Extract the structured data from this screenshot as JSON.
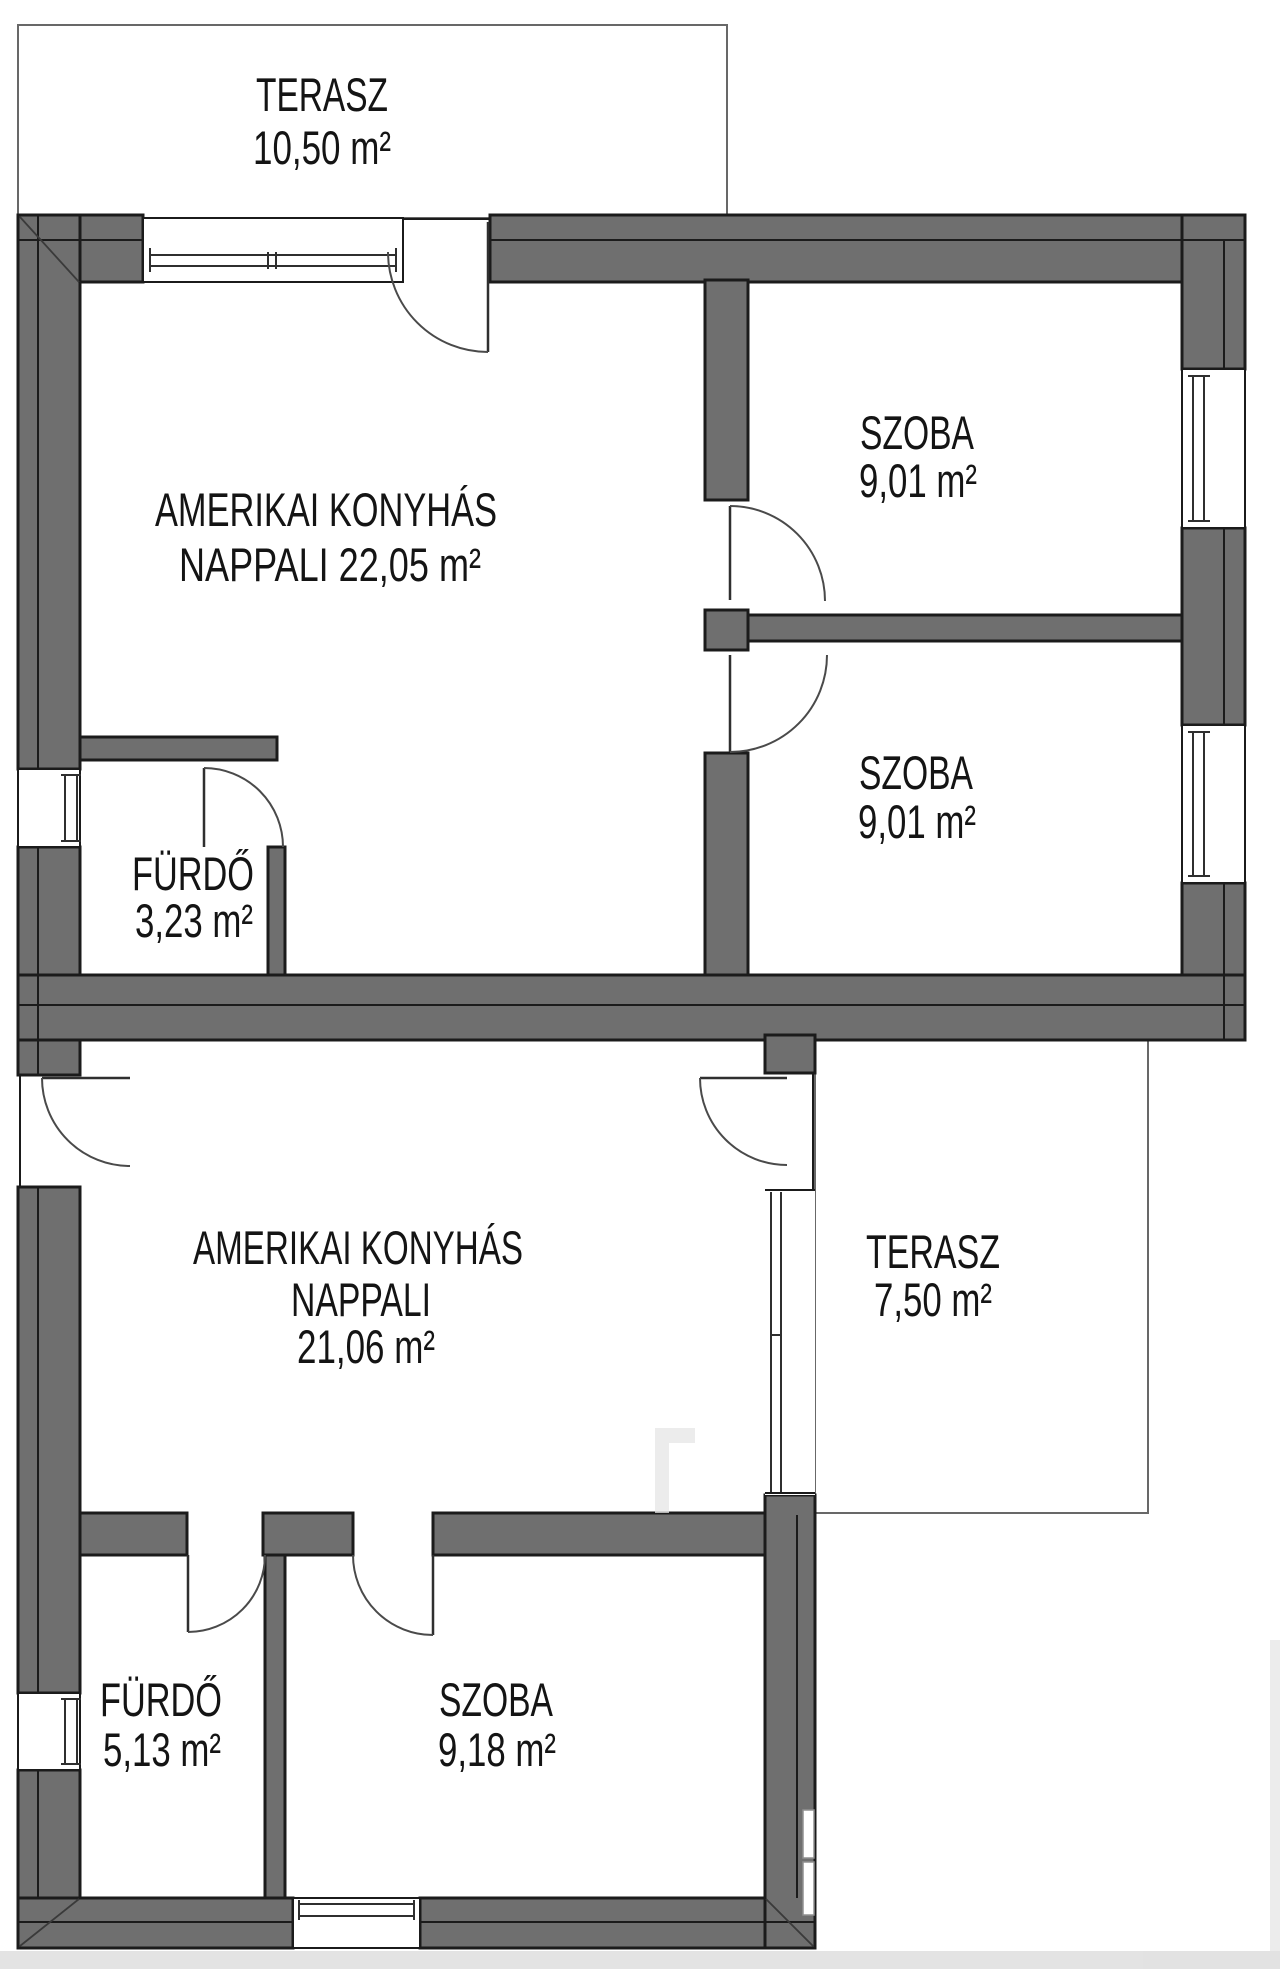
{
  "plan": {
    "type": "floor-plan",
    "language": "hu"
  },
  "rooms": [
    {
      "id": "terasz-felso",
      "lines": [
        "TERASZ",
        "10,50 m²"
      ]
    },
    {
      "id": "nappali-felso",
      "lines": [
        "AMERIKAI KONYHÁS",
        "NAPPALI  22,05 m²"
      ]
    },
    {
      "id": "szoba-felso",
      "lines": [
        "SZOBA",
        "9,01 m²"
      ]
    },
    {
      "id": "szoba-kozepso",
      "lines": [
        "SZOBA",
        "9,01 m²"
      ]
    },
    {
      "id": "furdo-felso",
      "lines": [
        "FÜRDŐ",
        "3,23 m²"
      ]
    },
    {
      "id": "nappali-also",
      "lines": [
        "AMERIKAI KONYHÁS",
        "NAPPALI",
        "21,06 m²"
      ]
    },
    {
      "id": "terasz-also",
      "lines": [
        "TERASZ",
        "7,50 m²"
      ]
    },
    {
      "id": "furdo-also",
      "lines": [
        "FÜRDŐ",
        "5,13 m²"
      ]
    },
    {
      "id": "szoba-also",
      "lines": [
        "SZOBA",
        "9,18 m²"
      ]
    }
  ],
  "colors": {
    "background": "#ffffff",
    "wall_fill": "#6f6f6f",
    "wall_outline": "#1b1b1b",
    "terrace_outline": "#686868",
    "glass_line": "#2f2f2f",
    "door_line": "#4a4a4a",
    "label_text": "#141414"
  }
}
